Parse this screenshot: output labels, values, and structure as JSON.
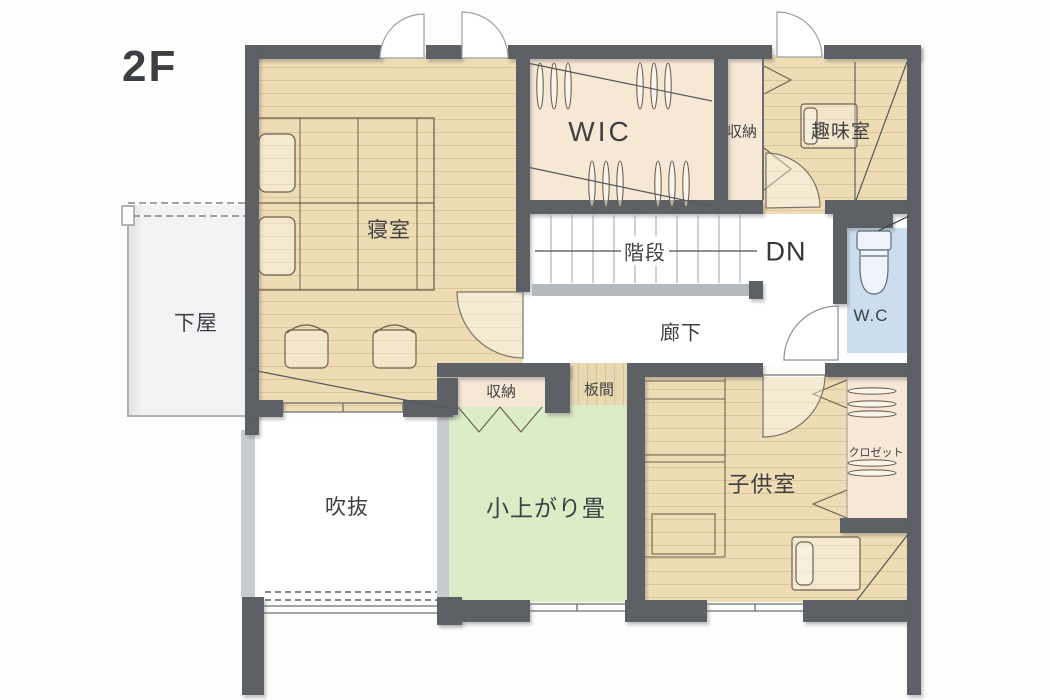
{
  "plan": {
    "title": "2F floor plan",
    "labels": {
      "floor": "2F",
      "shitaya": "下屋",
      "bedroom": "寝室",
      "wic": "WIC",
      "storage_top": "収納",
      "hobby": "趣味室",
      "stairs": "階段",
      "dn": "DN",
      "corridor": "廊下",
      "wc": "W.C",
      "storage_bottom": "収納",
      "itanoma": "板間",
      "void": "吹抜",
      "tatami": "小上がり畳",
      "kids": "子供室",
      "closet": "クロゼット"
    },
    "colors": {
      "wall": "#5d6165",
      "wood_floor": "#eedcb4",
      "wood_plank_line": "#dcc697",
      "closet_pink": "#f7e8d6",
      "tatami_green": "#dcecc6",
      "wc_blue": "#cadef0",
      "handrail": "#b4b9bd",
      "outside_area": "#f3f3f5",
      "label_text": "#3e4144"
    }
  }
}
